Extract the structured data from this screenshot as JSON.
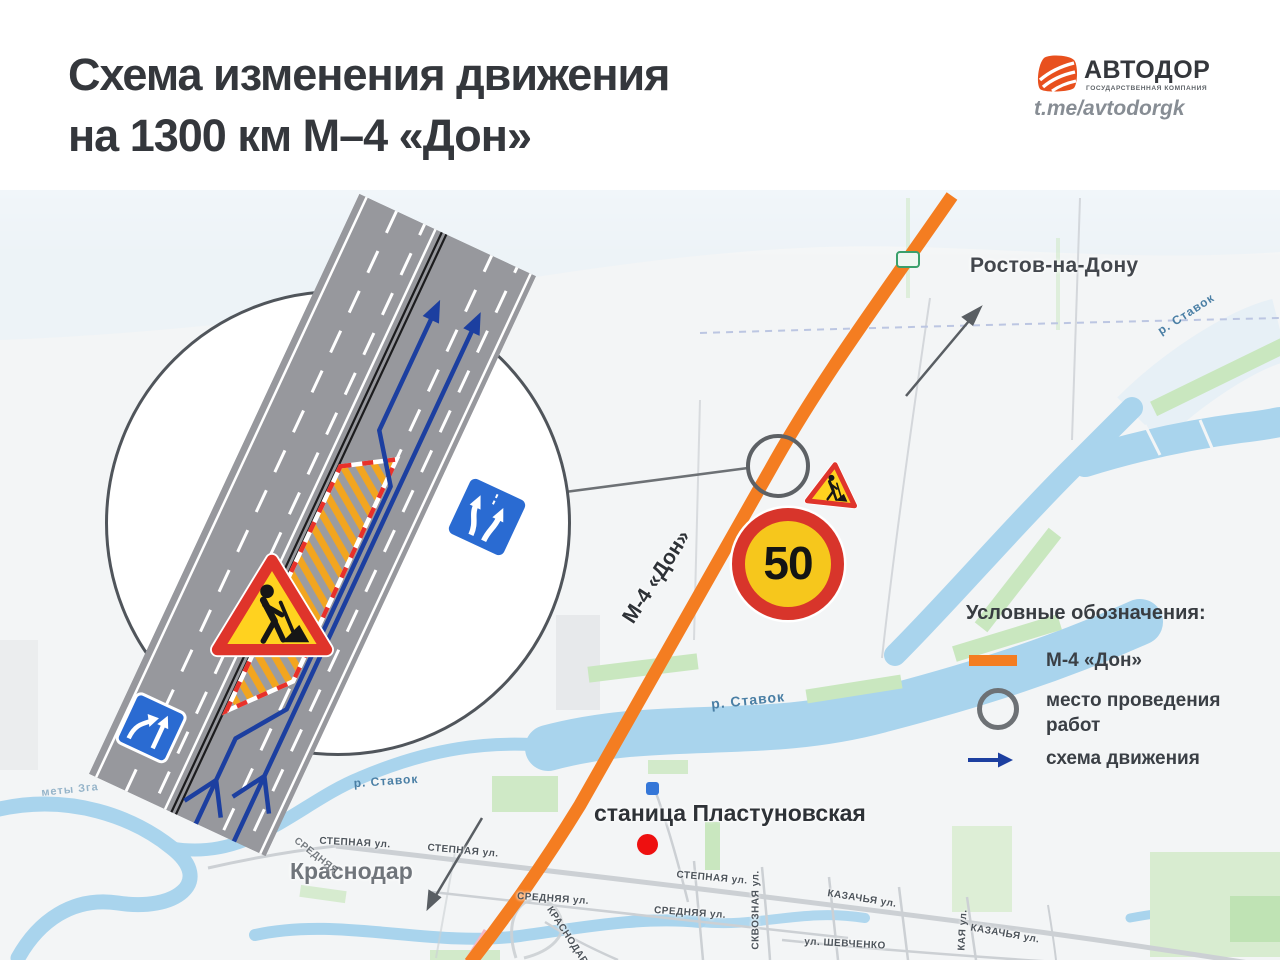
{
  "header": {
    "title_line1": "Схема изменения движения",
    "title_line2": "на 1300 км М–4 «Дон»",
    "logo": {
      "brand": "АВТОДОР",
      "subtitle": "ГОСУДАРСТВЕННАЯ КОМПАНИЯ",
      "telegram": "t.me/avtodorgk"
    }
  },
  "map": {
    "destination_top": "Ростов-на-Дону",
    "destination_bottom": "Краснодар",
    "settlement": "станица Пластуновская",
    "highway_label": "М-4 «Дон»",
    "speed_limit": "50",
    "rivers": [
      {
        "label": "р. Ставок"
      },
      {
        "label": "р. Ставок"
      },
      {
        "label": "р. Ставок"
      }
    ],
    "faint_label": "меты Зга",
    "streets": [
      {
        "label": "СТЕПНАЯ ул."
      },
      {
        "label": "СТЕПНАЯ ул."
      },
      {
        "label": "СТЕПНАЯ ул."
      },
      {
        "label": "СРЕДНЯЯ ул."
      },
      {
        "label": "СРЕДНЯЯ ул."
      },
      {
        "label": "КАЗАЧЬЯ ул."
      },
      {
        "label": "КАЗАЧЬЯ ул."
      },
      {
        "label": "СКВОЗНАЯ ул."
      },
      {
        "label": "ул. ШЕВЧЕНКО"
      },
      {
        "label": "КРАСНОДАРСКАЯ"
      },
      {
        "label": "КАЯ ул."
      },
      {
        "label": "СРЕДНЯЯ"
      }
    ]
  },
  "legend": {
    "title": "Условные обозначения:",
    "items": [
      {
        "label": "М-4 «Дон»"
      },
      {
        "label": "место проведения работ"
      },
      {
        "label": "схема движения"
      }
    ]
  },
  "colors": {
    "highway": "#F47D21",
    "scheme_arrow": "#1C3FA0",
    "work_zone_orange": "#F2A51F",
    "sign_blue": "#2A6BD2",
    "alert_red": "#E0392E",
    "water": "#A9D4ED",
    "green": "#C9E7BF"
  }
}
